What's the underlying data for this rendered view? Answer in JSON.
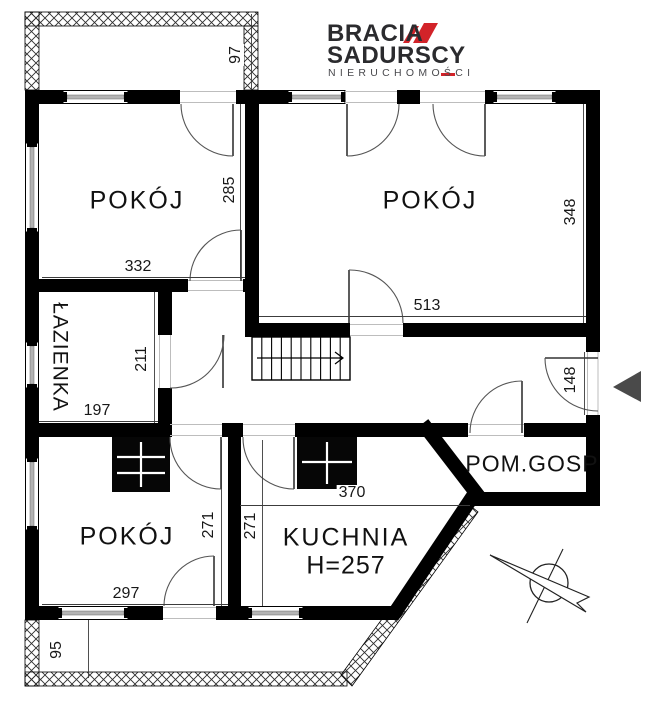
{
  "logo": {
    "brand_top": "BRACIA",
    "brand_bottom": "SADURSCY",
    "tagline": "NIERUCHOMOŚCI",
    "accent_color": "#d22329"
  },
  "rooms": {
    "top_left": {
      "label": "POKÓJ"
    },
    "top_right": {
      "label": "POKÓJ"
    },
    "bottom_left": {
      "label": "POKÓJ"
    },
    "bathroom": {
      "label": "ŁAZIENKA"
    },
    "kitchen": {
      "label": "KUCHNIA",
      "height_note": "H=257"
    },
    "utility": {
      "label": "POM.GOSP"
    }
  },
  "dimensions": {
    "balcony_top_depth": "97",
    "room_top_left_width": "332",
    "room_top_left_height": "285",
    "room_top_right_width": "513",
    "room_top_right_height": "348",
    "bathroom_width": "197",
    "bathroom_height": "211",
    "entry_hall_width": "148",
    "kitchen_width": "370",
    "kitchen_height": "271",
    "room_bottom_left_height": "271",
    "room_bottom_left_width": "297",
    "balcony_bottom_depth": "95"
  },
  "colors": {
    "wall": "#000000",
    "window_fill": "#b3b3b3",
    "entrance_arrow": "#4a4a4a",
    "logo_red": "#d22329"
  }
}
